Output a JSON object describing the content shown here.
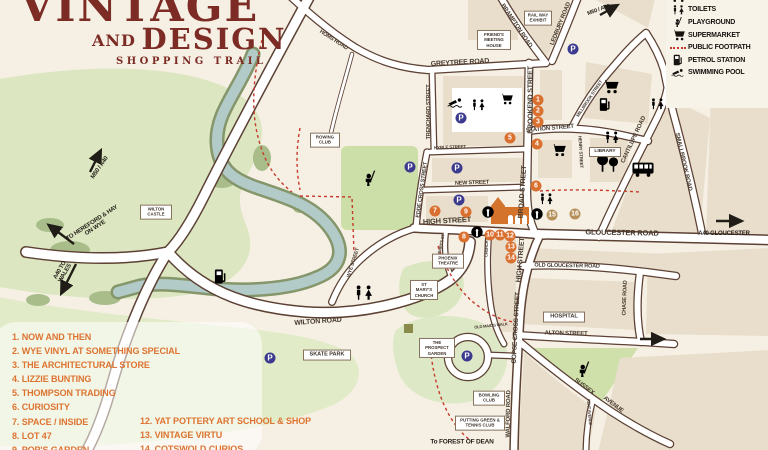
{
  "logo": {
    "title": "VINTAGE",
    "and": "AND",
    "design": "DESIGN",
    "tagline": "SHOPPING TRAIL"
  },
  "legend": {
    "items": [
      {
        "icon": "bus-icon",
        "label": "BUS STATION"
      },
      {
        "icon": "toilets-icon",
        "label": "TOILETS"
      },
      {
        "icon": "playground-icon",
        "label": "PLAYGROUND"
      },
      {
        "icon": "supermarket-icon",
        "label": "SUPERMARKET"
      },
      {
        "icon": "footpath-dashes",
        "label": "PUBLIC FOOTPATH"
      },
      {
        "icon": "petrol-icon",
        "label": "PETROL STATION"
      },
      {
        "icon": "swimming-icon",
        "label": "SWIMMING POOL"
      }
    ]
  },
  "trail": {
    "left": [
      "1. NOW AND THEN",
      "2. WYE VINYL AT SOMETHING SPECIAL",
      "3. THE ARCHITECTURAL STORE",
      "4. LIZZIE BUNTING",
      "5. THOMPSON TRADING",
      "6. CURIOSITY",
      "7. SPACE / INSIDE",
      "8. LOT 47",
      "9. POP'S GARDEN"
    ],
    "right": [
      "12. YAT POTTERY ART SCHOOL & SHOP",
      "13. VINTAGE VIRTU",
      "14. COTSWOLD CURIOS"
    ]
  },
  "map": {
    "streets": [
      "HOMS ROAD",
      "GREYTREE ROAD",
      "TRENCHARD STREET",
      "BRAMPTON ROAD",
      "LEDBURY ROAD",
      "BROOKEND STREET",
      "STATION STREET",
      "MILLBROOK STREET",
      "HENRY STREET",
      "CANTILUPE ROAD",
      "SMALLBROOK ROAD",
      "KYRLE STREET",
      "NEW STREET",
      "EDDE CROSS STREET",
      "BROAD STREET",
      "HIGH STREET",
      "GLOUCESTER ROAD",
      "HIGH STREET",
      "OLD GLOUCESTER ROAD",
      "COPSE CROSS STREET",
      "CHURCH ST",
      "ST MARY'S ST",
      "ALTON STREET",
      "CHASE ROAD",
      "OLD MAID'S WALK",
      "WILTON ROAD",
      "WYE STREET",
      "SUSSEX",
      "AVENUE",
      "KENT AVENUE",
      "WALFORD ROAD"
    ],
    "places": [
      "RAIL WAY EXHIBIT",
      "FRIEND'S MEETING HOUSE",
      "LIBRARY",
      "HOSPITAL",
      "ST MARY'S CHURCH",
      "PHOENIX THEATRE",
      "THE PROSPECT GARDEN",
      "SKATE PARK",
      "ROWING CLUB",
      "WILTON CASTLE",
      "BOWLING CLUB",
      "PUTTING GREEN & TENNIS CLUB"
    ],
    "directions": [
      "TO HEREFORD & HAY ON WYE",
      "A40 TO WALES",
      "M50 / A40",
      "M50 / A40",
      "A40 GLOUCESTER",
      "To FOREST OF DEAN"
    ],
    "markers": [
      "1",
      "2",
      "3",
      "4",
      "5",
      "6",
      "7",
      "8",
      "9",
      "10",
      "11",
      "12",
      "13",
      "14",
      "15",
      "16"
    ]
  },
  "icons": {
    "parking": "P"
  },
  "colors": {
    "logo_maroon": "#7c2b25",
    "list_orange": "#dd7330",
    "marker_orange": "#da7030",
    "marker_tan": "#b5905a",
    "parking_blue": "#3c3a8e",
    "footpath_red": "#c7392b",
    "road_casing": "#5c4134",
    "river": "#b2cbc8",
    "land": "#f6f0e4",
    "block_tan": "#e8decb",
    "green": "#dce7c2"
  }
}
